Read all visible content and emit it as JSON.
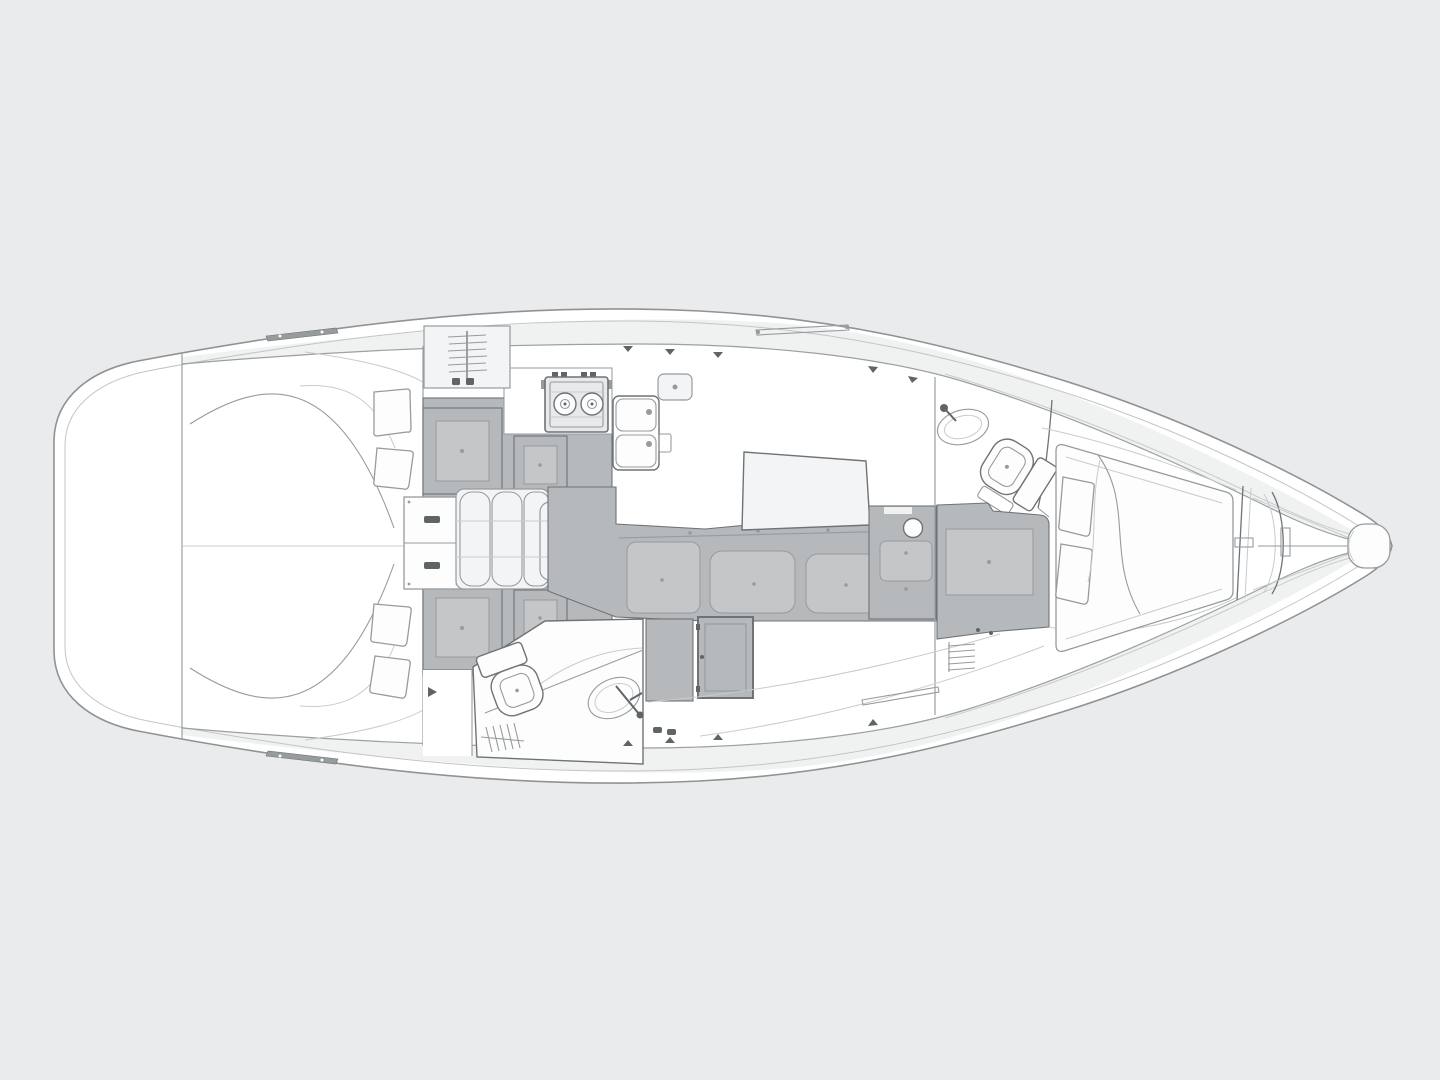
{
  "diagram": {
    "title": "Sailing yacht interior layout plan — top-down view, bow pointing right",
    "type": "technical line drawing / boat floor plan",
    "orientation": {
      "bow": "right",
      "stern": "left",
      "port": "top",
      "starboard": "bottom"
    },
    "areas": [
      {
        "id": "stern-platform",
        "label": "Rounded stern / transom platform"
      },
      {
        "id": "aft-cabin",
        "label": "Aft cabin with twin curved berths and four pillows"
      },
      {
        "id": "saloon",
        "label": "Saloon with folding leaf table, drawer cabinet and four upholstered seats"
      },
      {
        "id": "galley",
        "label": "Galley with two-burner stove and double sink"
      },
      {
        "id": "aft-head",
        "label": "Aft head with toilet, oval washbasin and shower grating"
      },
      {
        "id": "settee",
        "label": "Settee bench with three cushions and tilted saloon table"
      },
      {
        "id": "wet-unit",
        "label": "Counter unit with round basin"
      },
      {
        "id": "forward-head",
        "label": "Forward head with oval washbasin and toilet"
      },
      {
        "id": "forward-cabin",
        "label": "Forward V-berth cabin with mattress, two pillows and duvet"
      },
      {
        "id": "anchor-locker",
        "label": "Bow anchor locker"
      },
      {
        "id": "deck",
        "label": "Side decks with grab rails, cleats, vents and hatches"
      }
    ]
  },
  "colors": {
    "background": "#eaebec",
    "hullFill": "#ffffff",
    "hullLine": "#8f9396",
    "innerLine": "#c2c5c7",
    "cabinLine": "#9aa0a3",
    "deckBand": "#f0f1f1",
    "gray": "#b6b9bb",
    "grayLight": "#c4c6c8",
    "border": "#6e7377",
    "detailMid": "#969b9e",
    "light": "#c8cbcd",
    "lightFill": "#f3f4f5",
    "appliance": "#e7e9ea",
    "accent": "#5f6467",
    "white": "#fdfdfe"
  }
}
